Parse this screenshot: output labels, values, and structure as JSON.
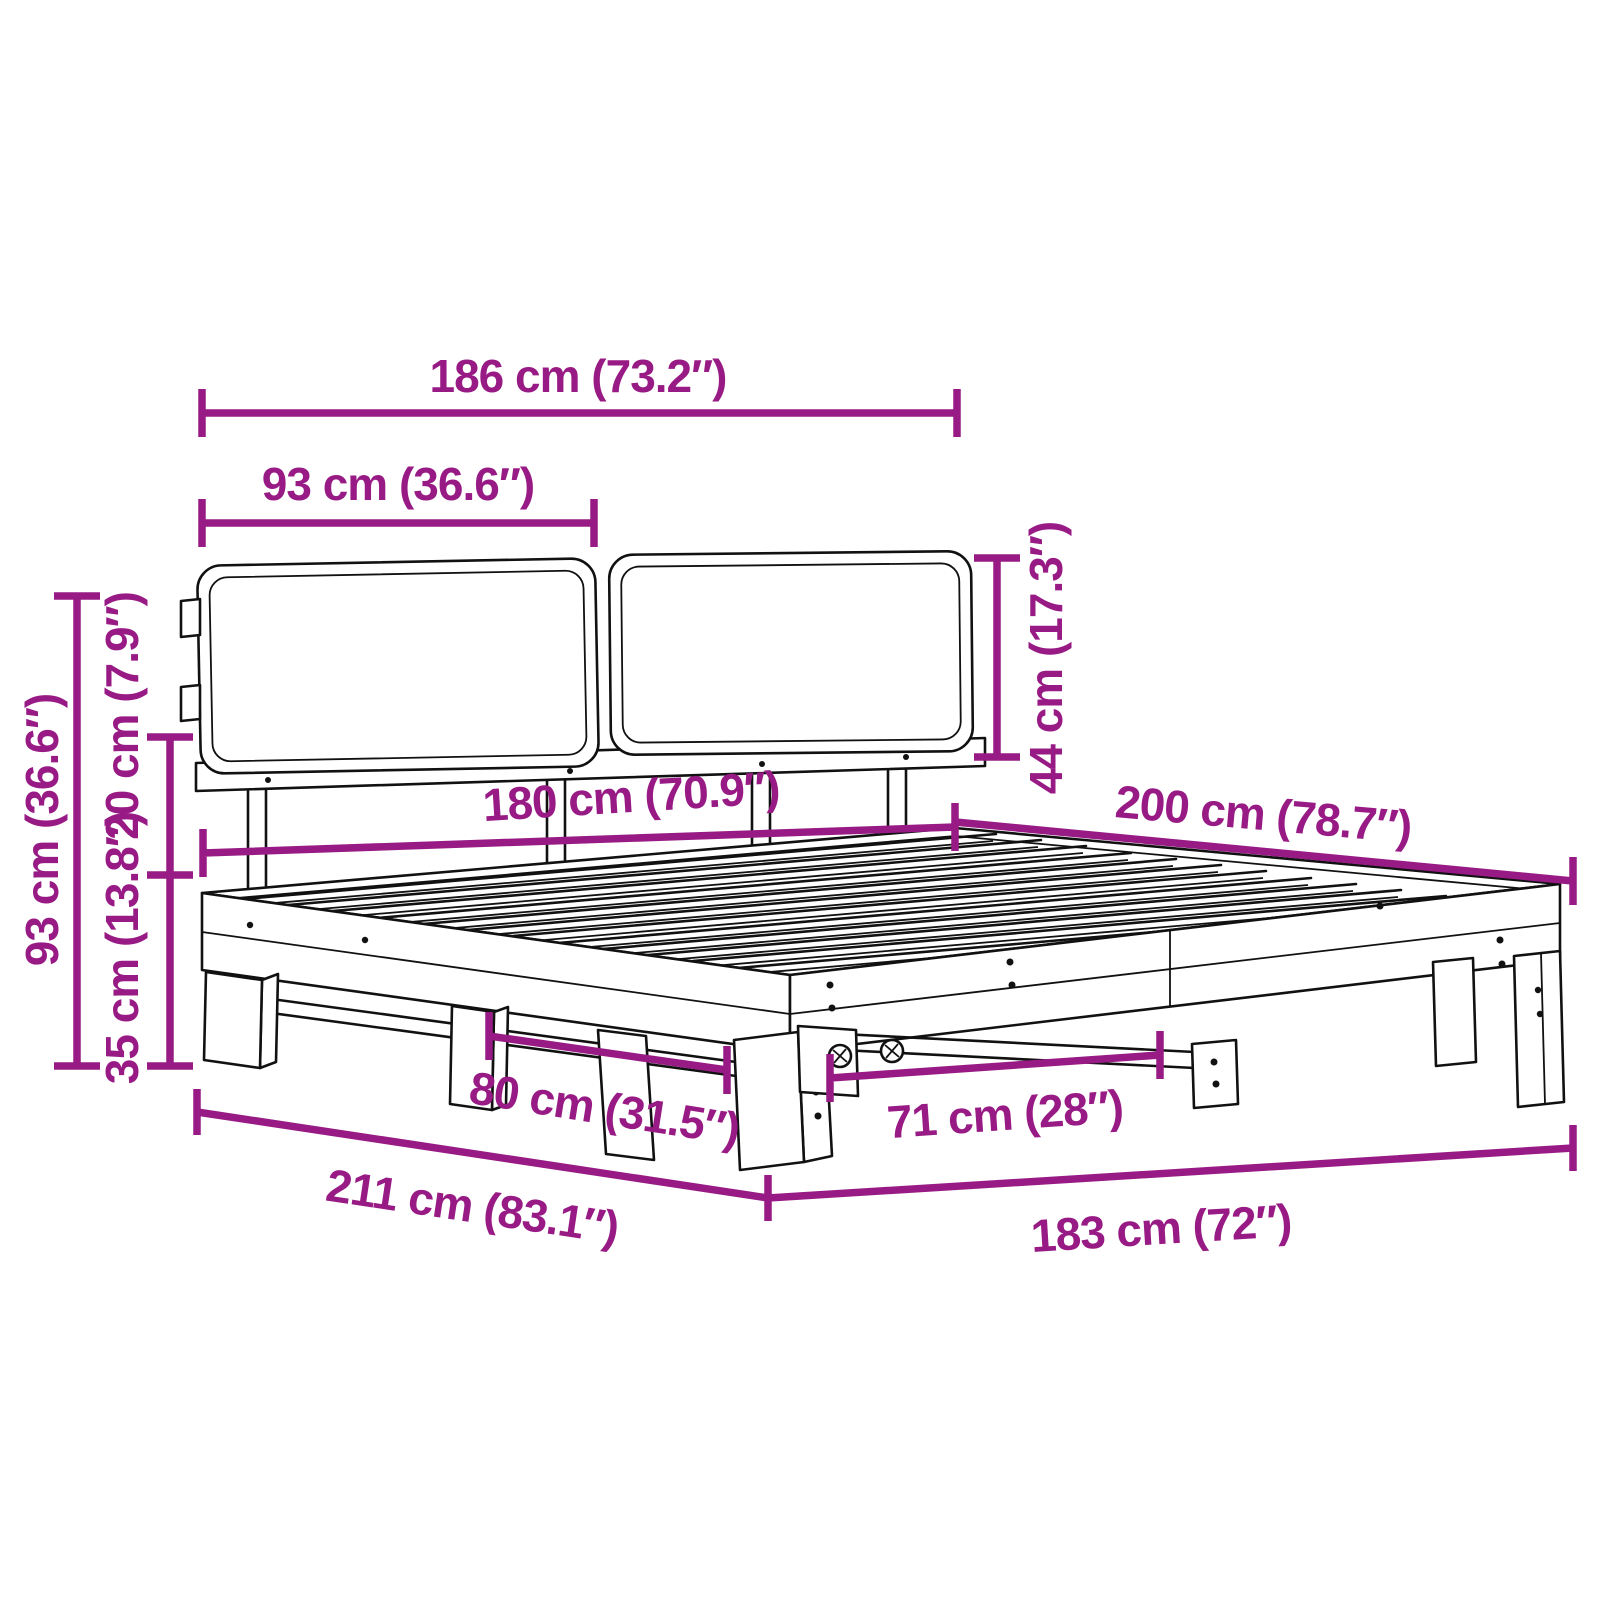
{
  "meta": {
    "description": "Bed frame with two headboard cushions and slatted base — product dimension diagram"
  },
  "colors": {
    "dimension": "#981B85",
    "line_art": "#111111",
    "background": "#ffffff"
  },
  "units": {
    "primary": "cm",
    "secondary": "inches"
  },
  "dimensions": {
    "overall_width": "186 cm (73.2″)",
    "cushion_width": "93 cm (36.6″)",
    "cushion_height": "44 cm (17.3″)",
    "bed_width": "180 cm (70.9″)",
    "bed_length": "200 cm (78.7″)",
    "overall_height": "93 cm (36.6″)",
    "headboard_clearance": "20 cm (7.9″)",
    "base_height": "35 cm (13.8″)",
    "leg_spacing_side": "80 cm (31.5″)",
    "leg_spacing_foot": "71 cm (28″)",
    "footprint_length": "211 cm (83.1″)",
    "footprint_width": "183 cm (72″)"
  }
}
